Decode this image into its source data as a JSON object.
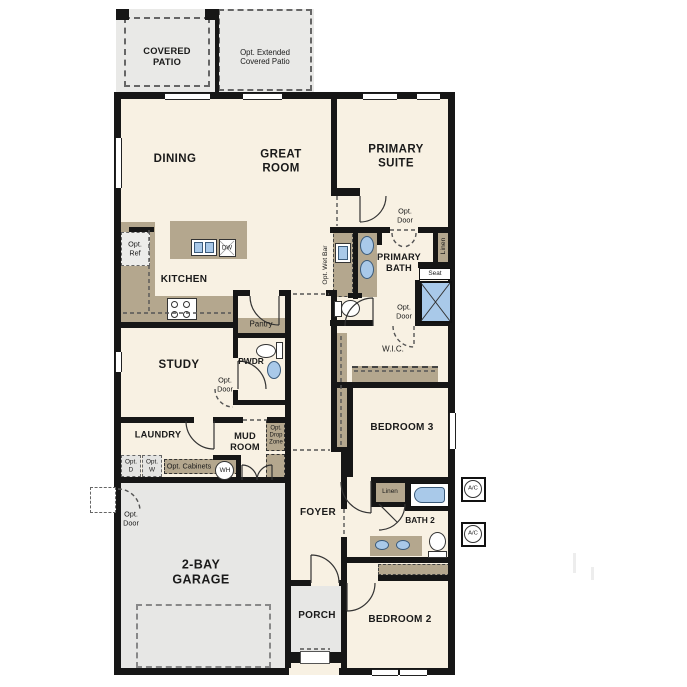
{
  "plan_title": "Single-story floor plan",
  "colors": {
    "wall": "#161616",
    "floor": "#f8f1e3",
    "counter": "#b4a78e",
    "blue": "#a9c9e9",
    "patio": "#e9e9e7",
    "garage": "#e7e7e5",
    "dash": "#666",
    "ink": "#1a1a1a"
  },
  "labels": {
    "covered_patio": "COVERED\nPATIO",
    "opt_extended_patio": "Opt. Extended\nCovered Patio",
    "dining": "DINING",
    "great_room": "GREAT\nROOM",
    "primary_suite": "PRIMARY\nSUITE",
    "primary_bath": "PRIMARY\nBATH",
    "opt_door": "Opt.\nDoor",
    "opt_ref": "Opt.\nRef",
    "opt_wet_bar": "Opt. Wet Bar",
    "linen": "Linen",
    "seat": "Seat",
    "kitchen": "KITCHEN",
    "pantry": "Pantry",
    "pwdr": "PWDR",
    "wic": "W.I.C.",
    "study": "STUDY",
    "laundry": "LAUNDRY",
    "mud_room": "MUD\nROOM",
    "opt_d": "Opt.\nD",
    "opt_w": "Opt.\nW",
    "opt_cabinets": "Opt. Cabinets",
    "wh": "WH",
    "opt_drop_zone": "Opt.\nDrop\nZone",
    "garage": "2-BAY\nGARAGE",
    "foyer": "FOYER",
    "porch": "PORCH",
    "bedroom3": "BEDROOM 3",
    "bath2": "BATH 2",
    "bedroom2": "BEDROOM 2",
    "dw": "DW",
    "ac": "A/C"
  }
}
